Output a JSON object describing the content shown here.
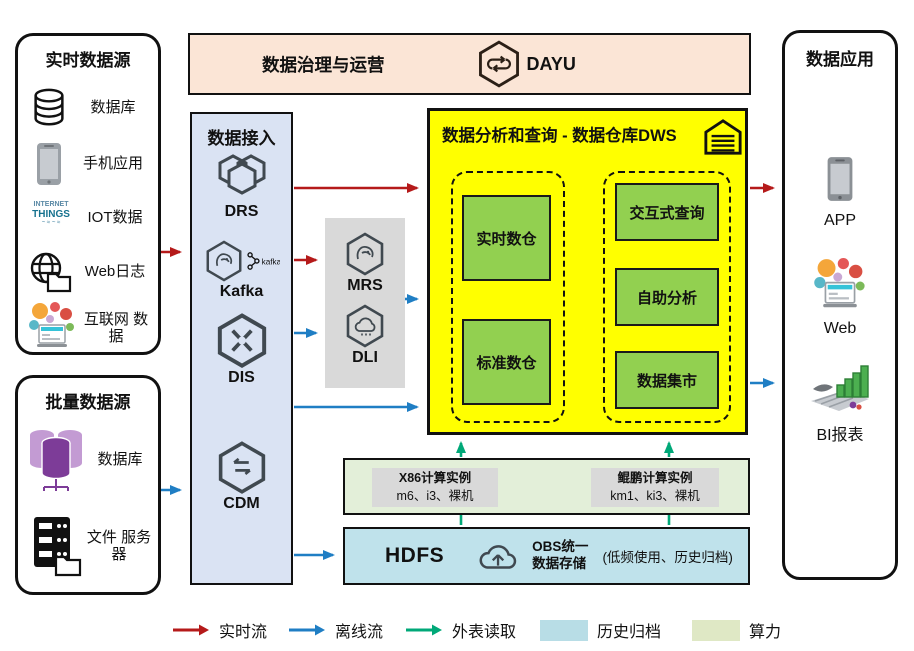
{
  "colors": {
    "realtime_flow": "#b51a1a",
    "offline_flow": "#1f7ec4",
    "external_read": "#00a878",
    "archive_fill": "#b8dde6",
    "compute_fill": "#dfe8c5",
    "dws_bg": "#ffff00",
    "warehouse_green": "#92d050",
    "access_bg": "#dae3f3",
    "governance_bg": "#fbe5d6",
    "gray_box": "#d9d9d9"
  },
  "realtime_sources": {
    "title": "实时数据源",
    "iot_words": [
      "INTERNET",
      "THINGS"
    ],
    "items": [
      {
        "icon": "database-icon",
        "label": "数据库"
      },
      {
        "icon": "phone-icon",
        "label": "手机应用"
      },
      {
        "icon": "iot-wordcloud-icon",
        "label": "IOT数据"
      },
      {
        "icon": "web-globe-folder-icon",
        "label": "Web日志"
      },
      {
        "icon": "internet-bubbles-icon",
        "label": "互联网 数据"
      }
    ]
  },
  "batch_sources": {
    "title": "批量数据源",
    "items": [
      {
        "icon": "purple-database-cluster-icon",
        "label": "数据库"
      },
      {
        "icon": "file-server-icon",
        "label": "文件 服务器"
      }
    ]
  },
  "governance": {
    "title": "数据治理与运营",
    "product": "DAYU",
    "icon": "dayu-hexagon-icon"
  },
  "access": {
    "title": "数据接入",
    "kafka_badge": "kafka",
    "services": [
      "DRS",
      "Kafka",
      "DIS",
      "CDM"
    ]
  },
  "processing": {
    "services": [
      "MRS",
      "DLI"
    ]
  },
  "dws": {
    "title": "数据分析和查询 - 数据仓库DWS",
    "icon": "warehouse-icon",
    "left_group": [
      "实时数仓",
      "标准数仓"
    ],
    "right_group": [
      "交互式查询",
      "自助分析",
      "数据集市"
    ]
  },
  "compute": {
    "instances": [
      {
        "name": "X86计算实例",
        "specs": "m6、i3、裸机"
      },
      {
        "name": "鲲鹏计算实例",
        "specs": "km1、ki3、裸机"
      }
    ]
  },
  "storage": {
    "name": "HDFS",
    "icon": "obs-cloud-upload-icon",
    "obs_line1": "OBS统一",
    "obs_line2": "数据存储",
    "note": "(低频使用、历史归档)"
  },
  "apps": {
    "title": "数据应用",
    "items": [
      {
        "icon": "phone-icon",
        "label": "APP"
      },
      {
        "icon": "web-bubbles-icon",
        "label": "Web"
      },
      {
        "icon": "bi-barchart-icon",
        "label": "BI报表"
      }
    ]
  },
  "legend": {
    "items": [
      {
        "type": "arrow",
        "color": "#b51a1a",
        "label": "实时流"
      },
      {
        "type": "arrow",
        "color": "#1f7ec4",
        "label": "离线流"
      },
      {
        "type": "arrow",
        "color": "#00a878",
        "label": "外表读取"
      },
      {
        "type": "swatch",
        "color": "#b8dde6",
        "label": "历史归档"
      },
      {
        "type": "swatch",
        "color": "#dfe8c5",
        "label": "算力"
      }
    ]
  }
}
